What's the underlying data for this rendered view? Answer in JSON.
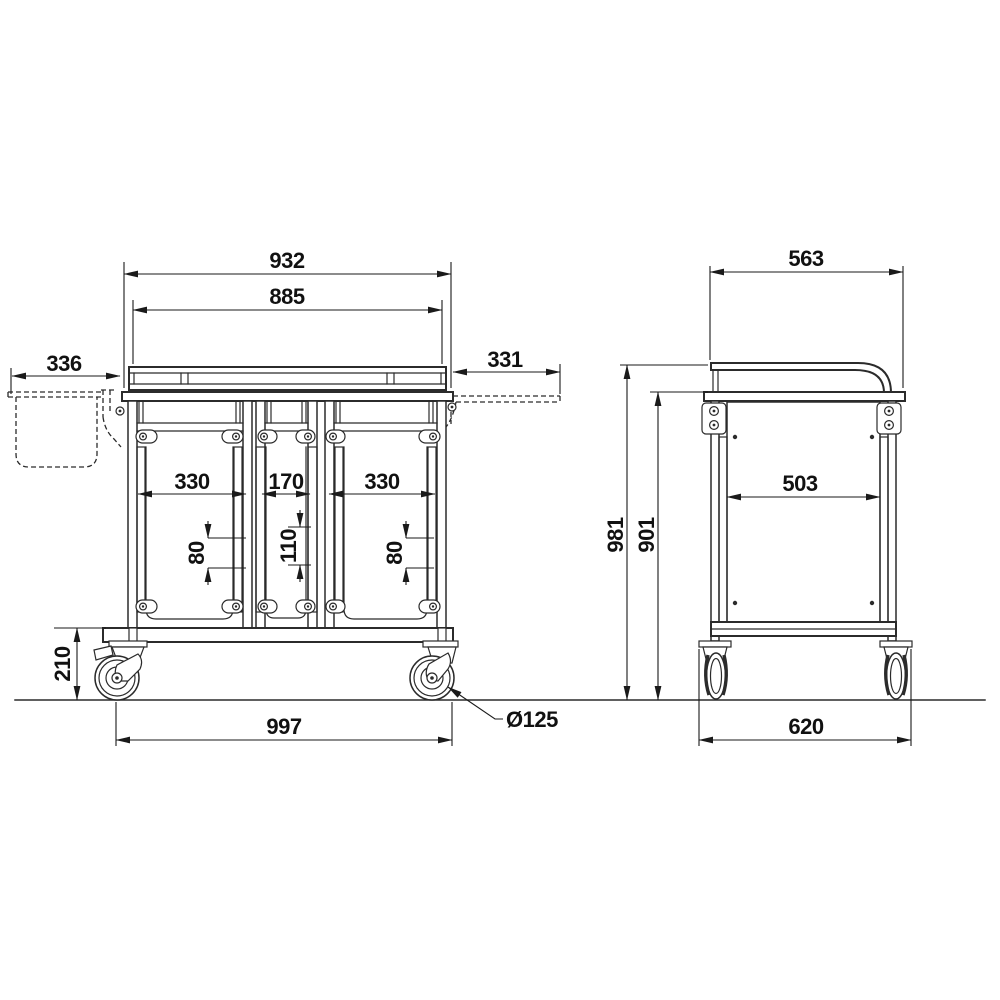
{
  "drawing": {
    "type": "technical-dimension-drawing",
    "subject": "three-bay trolley with casters, front and side orthographic views",
    "colors": {
      "line": "#2b2b2b",
      "dimension": "#1a1a1a",
      "background": "#ffffff",
      "text": "#111111"
    }
  },
  "front_view": {
    "dims": {
      "overall_width_top": "932",
      "gallery_width": "885",
      "left_basket_extension": "336",
      "right_shelf_extension": "331",
      "bay_left_width": "330",
      "bay_middle_width": "170",
      "bay_right_width": "330",
      "slot_pitch_left": "80",
      "slot_pitch_middle": "110",
      "slot_pitch_right": "80",
      "clearance_height": "210",
      "wheelbase_overall": "997",
      "caster_diameter": "Ø125"
    }
  },
  "side_view": {
    "dims": {
      "top_depth": "563",
      "overall_height": "981",
      "worktop_height": "901",
      "inner_depth": "503",
      "bottom_depth": "620"
    }
  }
}
